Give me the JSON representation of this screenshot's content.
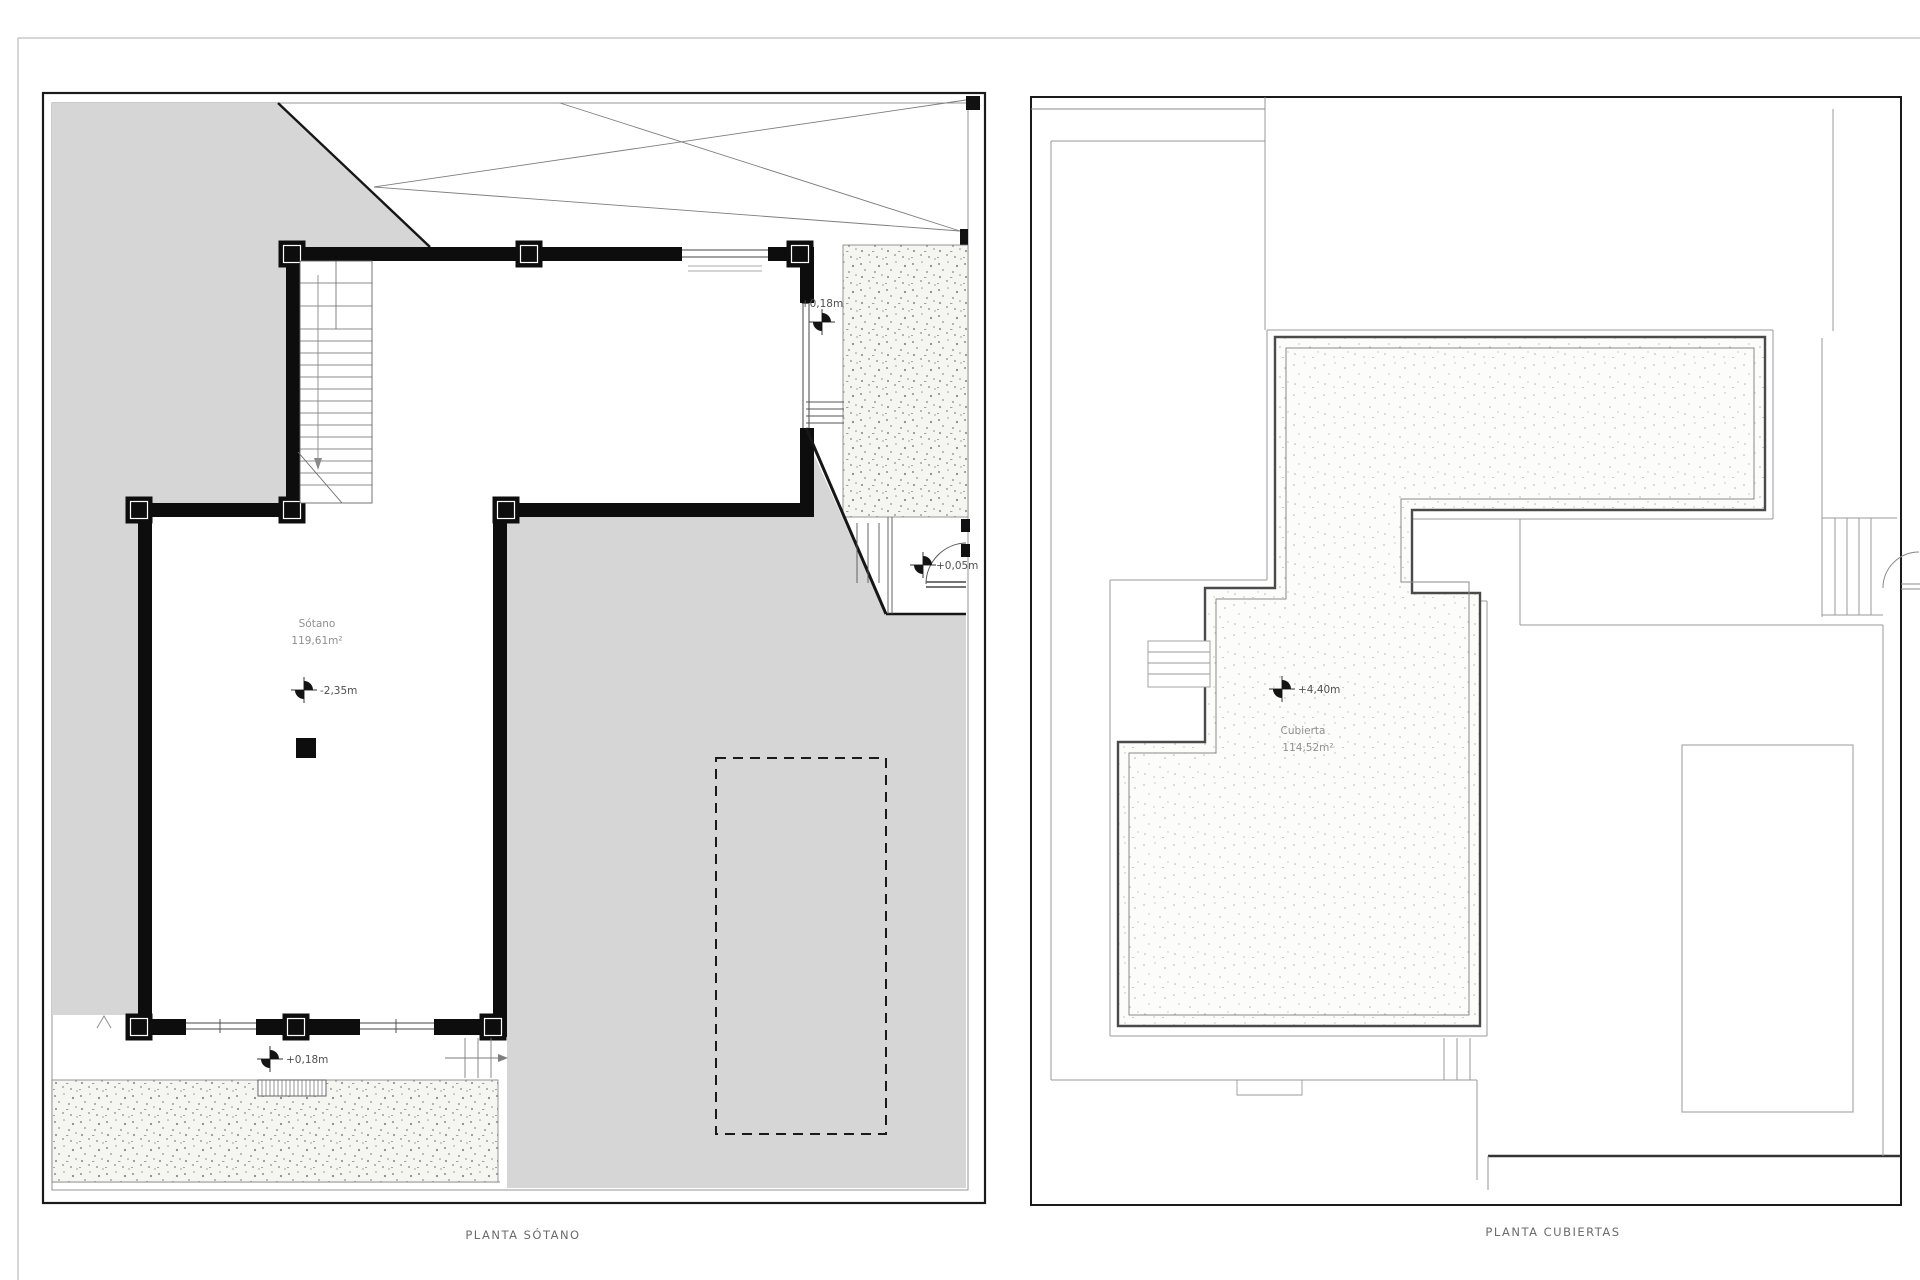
{
  "drawing": {
    "title": "floor plans",
    "background": "#ffffff",
    "site_fill": "#d6d6d6",
    "wall_color": "#0d0d0d",
    "line_color": "#999999"
  },
  "plans": {
    "basement": {
      "caption": "PLANTA SÓTANO",
      "room_label": "Sótano",
      "room_area": "119,61m²",
      "levels": {
        "terrace_right": "+0,18m",
        "terrace_bottom": "+0,18m",
        "floor": "-2,35m",
        "entry": "+0,05m"
      }
    },
    "roof": {
      "caption": "PLANTA CUBIERTAS",
      "room_label": "Cubierta",
      "room_area": "114,52m²",
      "levels": {
        "roof_top": "+4,40m"
      }
    }
  }
}
